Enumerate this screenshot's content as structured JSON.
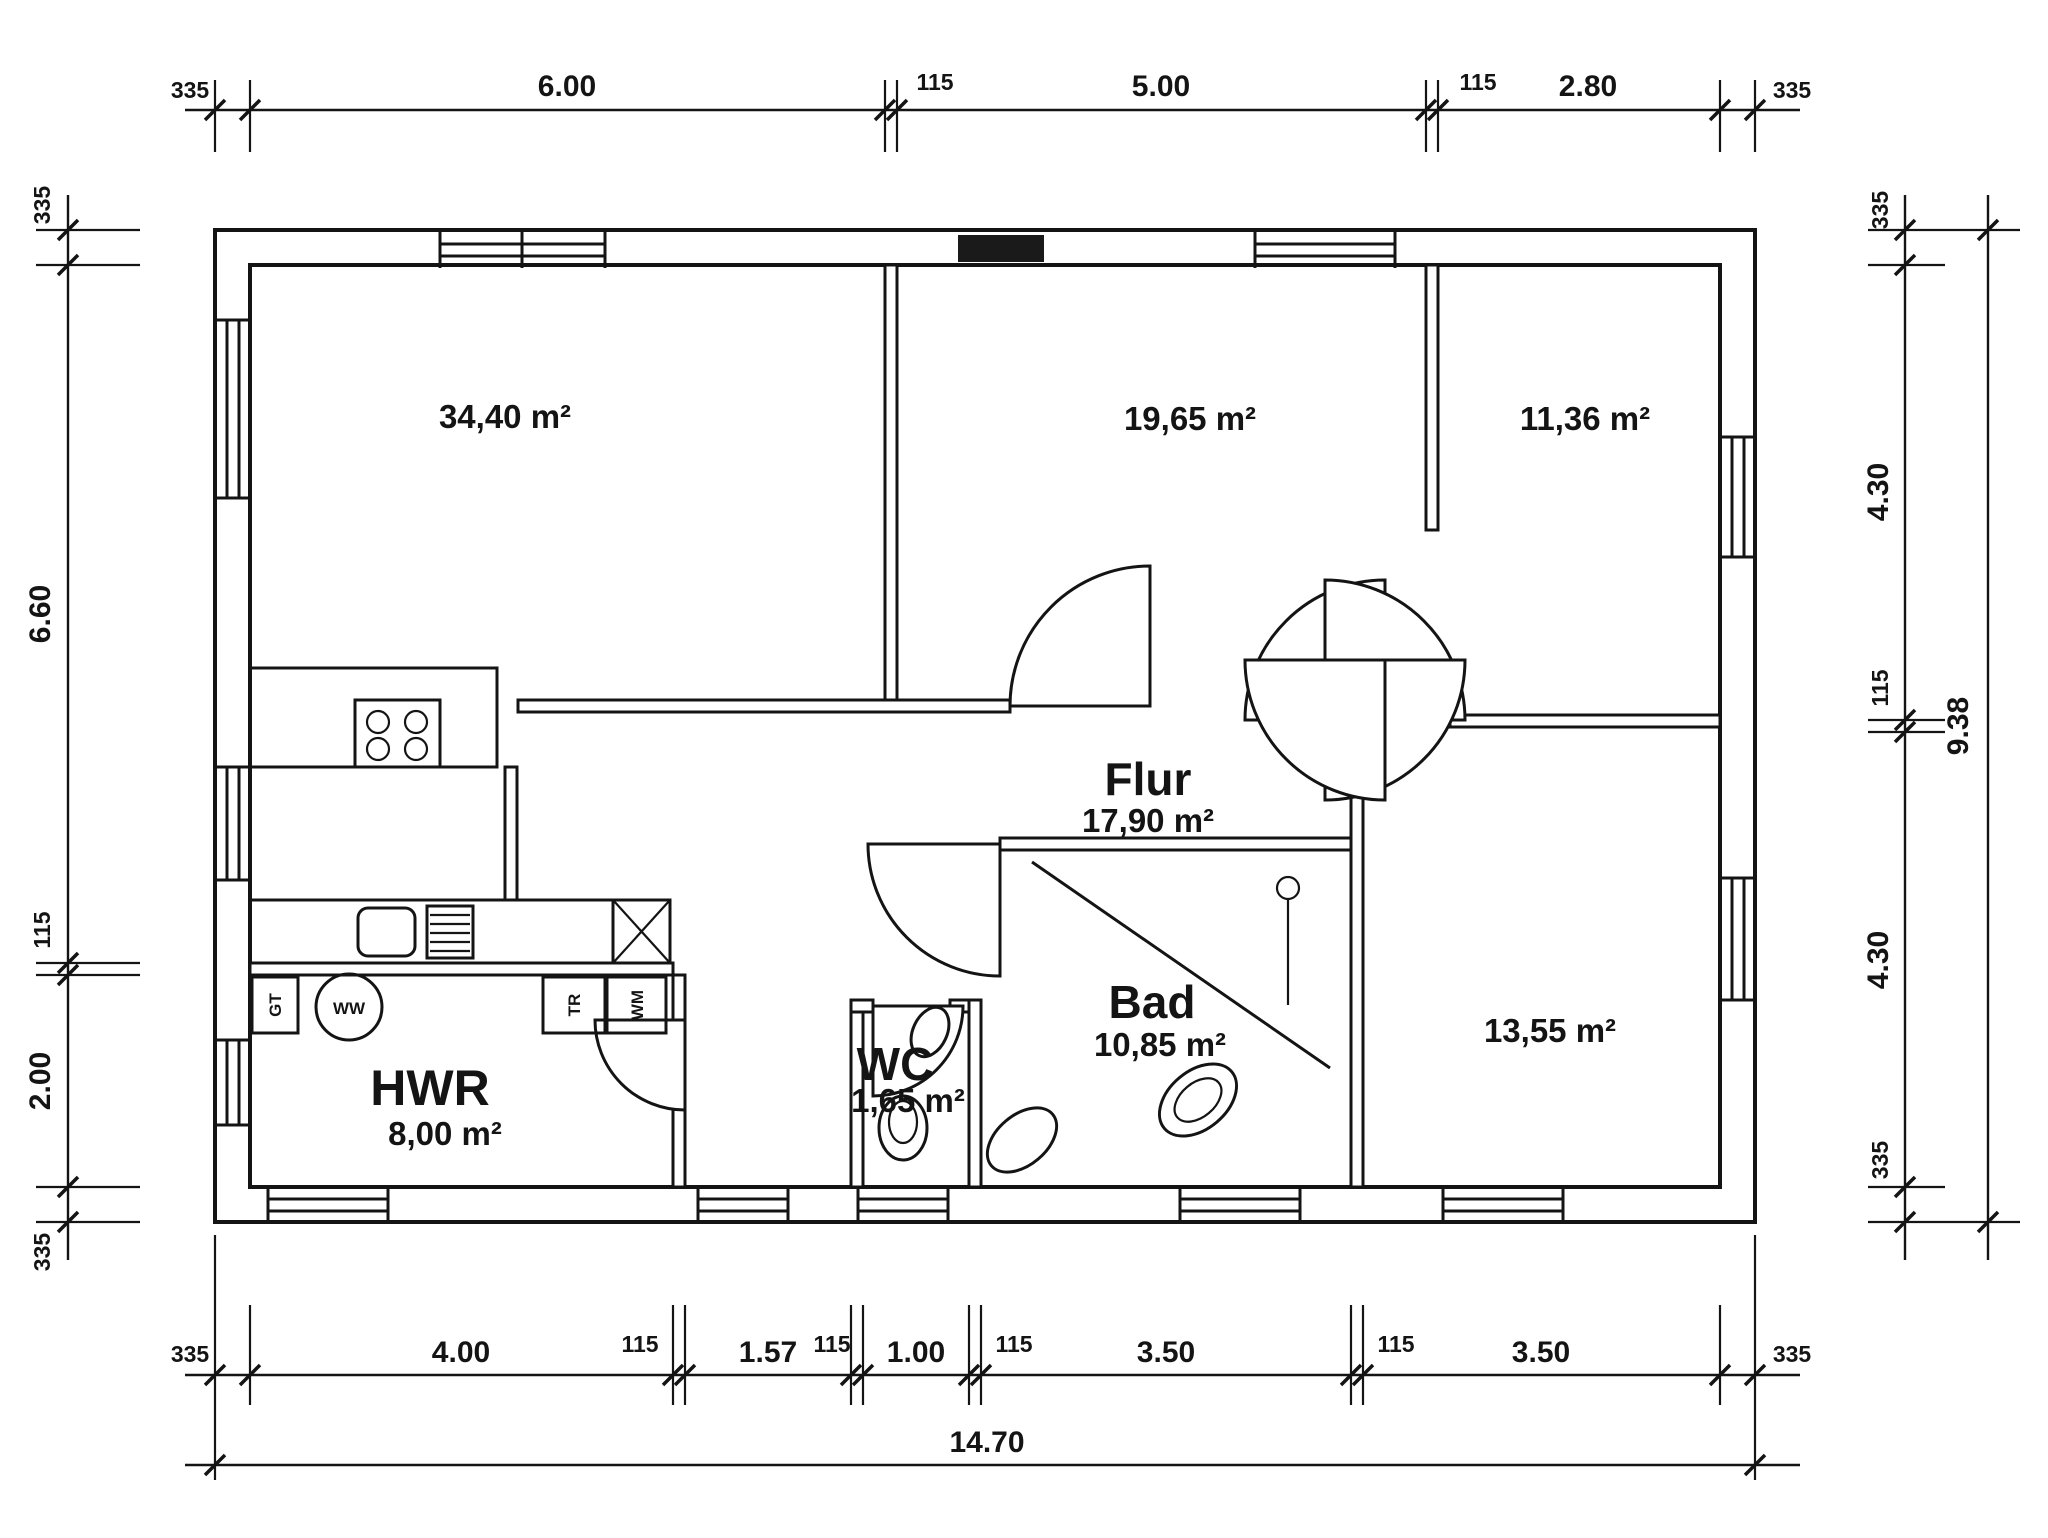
{
  "plan": {
    "title": "floor-plan",
    "rooms": {
      "living": {
        "name": "",
        "area": "34,40 m²"
      },
      "room2": {
        "name": "",
        "area": "19,65 m²"
      },
      "room3": {
        "name": "",
        "area": "11,36 m²"
      },
      "flur": {
        "name": "Flur",
        "area": "17,90 m²"
      },
      "bad": {
        "name": "Bad",
        "area": "10,85 m²"
      },
      "wc": {
        "name": "WC",
        "area": "1,65 m²"
      },
      "hwr": {
        "name": "HWR",
        "area": "8,00 m²"
      },
      "room8": {
        "name": "",
        "area": "13,55 m²"
      }
    },
    "appliances": {
      "gt": "GT",
      "ww": "WW",
      "tr": "TR",
      "wm": "WM"
    },
    "dims": {
      "top": [
        "335",
        "6.00",
        "115",
        "5.00",
        "115",
        "2.80",
        "335"
      ],
      "left": [
        "335",
        "6.60",
        "115",
        "2.00",
        "335"
      ],
      "right": [
        "335",
        "4.30",
        "115",
        "4.30",
        "335"
      ],
      "right_total": "9.38",
      "bottom": [
        "335",
        "4.00",
        "115",
        "1.57",
        "115",
        "1.00",
        "115",
        "3.50",
        "115",
        "3.50",
        "335"
      ],
      "bottom_total": "14.70"
    }
  }
}
